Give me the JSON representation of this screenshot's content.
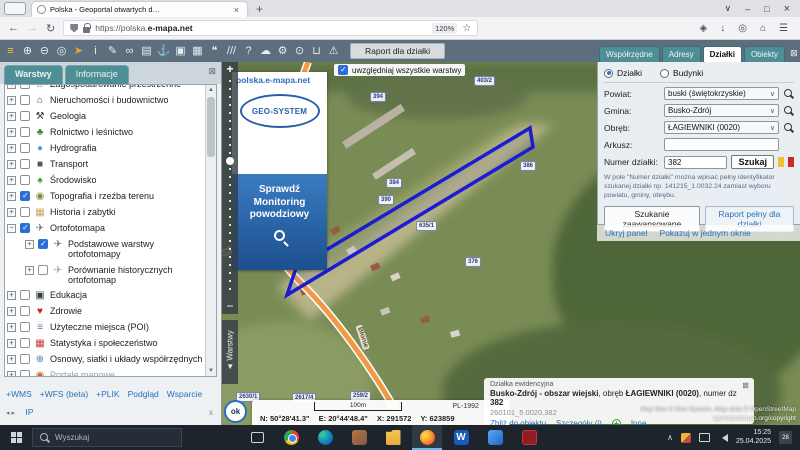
{
  "colors": {
    "accent_blue": "#2a6fbd",
    "teal": "#4e8e96",
    "parcel": "#1c1cd0",
    "road": "#f19a44",
    "toolbar_bg": "#5d6f7e"
  },
  "browser": {
    "tab_title": "Polska - Geoportal otwartych d…",
    "tab_close": "×",
    "new_tab": "+",
    "back": "←",
    "forward": "→",
    "reload": "↻",
    "url_prefix": "https://polska.",
    "url_domain": "e-mapa.net",
    "zoom_level": "120%",
    "star": "☆",
    "right_icons": [
      {
        "name": "pocket-icon",
        "g": "◈"
      },
      {
        "name": "downloads-icon",
        "g": "↓"
      },
      {
        "name": "account-icon",
        "g": "◎"
      },
      {
        "name": "home-icon",
        "g": "⌂"
      },
      {
        "name": "menu-icon",
        "g": "☰"
      }
    ],
    "win_list": "∨",
    "win_min": "–",
    "win_max": "□",
    "win_close": "×"
  },
  "toolbar": {
    "report_button": "Raport dla działki",
    "icons": [
      {
        "name": "layers-icon",
        "g": "≡",
        "c": "#f2c230"
      },
      {
        "name": "zoom-in-icon",
        "g": "⊕"
      },
      {
        "name": "zoom-out-icon",
        "g": "⊖"
      },
      {
        "name": "select-area-icon",
        "g": "◎"
      },
      {
        "name": "cursor-icon",
        "g": "➤",
        "c": "#f0a030"
      },
      {
        "name": "info-icon",
        "g": "i"
      },
      {
        "name": "measure-icon",
        "g": "✎"
      },
      {
        "name": "link-icon",
        "g": "∞"
      },
      {
        "name": "print-icon",
        "g": "▤"
      },
      {
        "name": "anchor-icon",
        "g": "⚓"
      },
      {
        "name": "copy-view-icon",
        "g": "▣"
      },
      {
        "name": "split-view-icon",
        "g": "▦"
      },
      {
        "name": "comment-icon",
        "g": "❝"
      },
      {
        "name": "measure-lines-icon",
        "g": "///"
      },
      {
        "name": "help-icon",
        "g": "?"
      },
      {
        "name": "upload-cloud-icon",
        "g": "☁"
      },
      {
        "name": "settings-icon",
        "g": "⚙"
      },
      {
        "name": "search-map-icon",
        "g": "⊙"
      },
      {
        "name": "cart-icon",
        "g": "⊔"
      },
      {
        "name": "warning-icon",
        "g": "⚠"
      }
    ]
  },
  "left_panel": {
    "tabs": [
      {
        "label": "Warstwy",
        "active": true
      },
      {
        "label": "Informacje",
        "active": false
      }
    ],
    "close_icon": "⊠",
    "scroll_up": "▲",
    "scroll_down": "▼",
    "layers": [
      {
        "label": "Zagospodarowanie przestrzenne",
        "expander": "+",
        "glyph": "⌂",
        "color": "#8a6d3b"
      },
      {
        "label": "Nieruchomości i budownictwo",
        "expander": "+",
        "glyph": "⌂",
        "color": "#44474a"
      },
      {
        "label": "Geologia",
        "expander": "+",
        "glyph": "⚒",
        "color": "#333"
      },
      {
        "label": "Rolnictwo i leśnictwo",
        "expander": "+",
        "glyph": "♣",
        "color": "#2e8b2e"
      },
      {
        "label": "Hydrografia",
        "expander": "+",
        "glyph": "●",
        "color": "#3fa9dd"
      },
      {
        "label": "Transport",
        "expander": "+",
        "glyph": "■",
        "color": "#555"
      },
      {
        "label": "Środowisko",
        "expander": "+",
        "glyph": "♠",
        "color": "#4a9b3a"
      },
      {
        "label": "Topografia i rzeźba terenu",
        "expander": "+",
        "checked": true,
        "glyph": "◉",
        "color": "#7a8b3a"
      },
      {
        "label": "Historia i zabytki",
        "expander": "+",
        "glyph": "▦",
        "color": "#c9a85c"
      },
      {
        "label": "Ortofotomapa",
        "expander": "−",
        "checked": true,
        "glyph": "✈",
        "color": "#6a7076"
      },
      {
        "label": "Podstawowe warstwy ortofotomapy",
        "expander": "+",
        "checked": true,
        "indent": true,
        "glyph": "✈",
        "color": "#6a7076"
      },
      {
        "label": "Porównanie historycznych ortofotomap",
        "expander": "+",
        "indent": true,
        "glyph": "✈",
        "color": "#9aa0a6"
      },
      {
        "label": "Edukacja",
        "expander": "+",
        "glyph": "▣",
        "color": "#2f3c44"
      },
      {
        "label": "Zdrowie",
        "expander": "+",
        "glyph": "♥",
        "color": "#cc2222"
      },
      {
        "label": "Użyteczne miejsca (POI)",
        "expander": "+",
        "glyph": "≡",
        "color": "#5577aa"
      },
      {
        "label": "Statystyka i społeczeństwo",
        "expander": "+",
        "glyph": "▦",
        "color": "#cc3333"
      },
      {
        "label": "Osnowy, siatki i układy współrzędnych",
        "expander": "+",
        "glyph": "⊕",
        "color": "#4a7ab5"
      },
      {
        "label": "Portale mapowe",
        "expander": "+",
        "muted": true,
        "glyph": "◉",
        "color": "#cc6633"
      },
      {
        "label": "Programy rządowe",
        "expander": "+",
        "glyph": "✉",
        "color": "#888"
      }
    ],
    "bottom_links": [
      {
        "label": "+WMS"
      },
      {
        "label": "+WFS (beta)"
      },
      {
        "label": "+PLIK"
      },
      {
        "label": "Podgląd"
      },
      {
        "label": "Wsparcie"
      }
    ],
    "pager_arrows": "◂ ▸",
    "ip_link": "IP",
    "foot_close": "x"
  },
  "map": {
    "all_layers_label": "uwzględniaj wszystkie warstwy",
    "watermark": "polska.e-mapa.net",
    "logo_text": "GEO-SYSTEM",
    "banner_line1": "Sprawdź",
    "banner_line2": "Monitoring",
    "banner_line3": "powodziowy",
    "zoom_plus": "+",
    "zoom_minus": "−",
    "warstwy_toggle": "◄ Warstwy",
    "streets": [
      {
        "label": "Pawła",
        "x": 6,
        "y": 180,
        "rot": -20
      },
      {
        "label": "Błonie",
        "x": 128,
        "y": 272,
        "rot": 72
      }
    ],
    "parcel_chips": [
      {
        "label": "403/2",
        "x": 252,
        "y": 14
      },
      {
        "label": "394",
        "x": 148,
        "y": 30
      },
      {
        "label": "384",
        "x": 164,
        "y": 116
      },
      {
        "label": "390",
        "x": 156,
        "y": 133
      },
      {
        "label": "386",
        "x": 298,
        "y": 99
      },
      {
        "label": "635/1",
        "x": 194,
        "y": 159
      },
      {
        "label": "376",
        "x": 243,
        "y": 195
      },
      {
        "label": "2630/1",
        "x": 14,
        "y": 330
      },
      {
        "label": "2617/4",
        "x": 70,
        "y": 331
      },
      {
        "label": "259/2",
        "x": 128,
        "y": 329
      }
    ],
    "ok_label": "ok",
    "scale_label": "100m",
    "crs_label": "PL-1992",
    "crs_caret": "∨",
    "coord_n": "N: 50°28'41.3\"",
    "coord_e": "E: 20°44'48.4\"",
    "coord_x": "X: 291572",
    "coord_y": "Y: 623859",
    "attribution_line1": "Map tiles © Geo-System, Map data © OpenStreetMap",
    "attribution_line2": "openstreetmap.org/copyright"
  },
  "info_card": {
    "title": "Działka ewidencyjna",
    "close": "⊠",
    "name_bold1": "Busko-Zdrój - obszar wiejski",
    "name_mid": ", obręb ",
    "name_bold2": "ŁAGIEWNIKI (0020)",
    "name_mid2": ", numer dz ",
    "name_bold3": "382",
    "parcel_id": "260101_5.0020.382",
    "link_zoom": "Zbliż do obiektu",
    "link_details": "Szczegóły (i)",
    "plus": "+",
    "link_other": "Inne"
  },
  "right_panel": {
    "tabs": [
      {
        "label": "Współrzędne",
        "active": false
      },
      {
        "label": "Adresy",
        "active": false
      },
      {
        "label": "Działki",
        "active": true
      },
      {
        "label": "Obiekty",
        "active": false
      }
    ],
    "close_icon": "⊠",
    "radio_parcels": "Działki",
    "radio_buildings": "Budynki",
    "fields": [
      {
        "label": "Powiat:",
        "value": "buski (świętokrzyskie)"
      },
      {
        "label": "Gmina:",
        "value": "Busko-Zdrój"
      },
      {
        "label": "Obręb:",
        "value": "ŁAGIEWNIKI (0020)"
      }
    ],
    "caret": "∨",
    "arkusz_label": "Arkusz:",
    "arkusz_value": "",
    "number_label": "Numer działki:",
    "number_value": "382",
    "search_button": "Szukaj",
    "hint": "W pole \"Numer działki\" można wpisać pełny identyfikator szukanej działki np. 141215_1.0032.24 zamiast wyboru powiatu, gminy, obrębu.",
    "btn_advanced": "Szukanie zaawansowane",
    "btn_report": "Raport pełny dla działki",
    "link_hide": "Ukryj panel",
    "link_one_window": "Pokazuj w jednym oknie"
  },
  "taskbar": {
    "search_placeholder": "Wyszukaj",
    "apps": [
      {
        "name": "task-view-icon",
        "cls": "taskview"
      },
      {
        "name": "chrome-icon",
        "cls": "chrome"
      },
      {
        "name": "edge-icon",
        "cls": "edge"
      },
      {
        "name": "hand-app-icon",
        "cls": "handapp"
      },
      {
        "name": "file-explorer-icon",
        "cls": "explorer"
      },
      {
        "name": "firefox-icon",
        "cls": "firefox",
        "active": true
      },
      {
        "name": "word-icon",
        "cls": "word",
        "letter": "W"
      },
      {
        "name": "photos-icon",
        "cls": "photos"
      },
      {
        "name": "acrobat-icon",
        "cls": "acrobat"
      }
    ],
    "tray_chevron": "∧",
    "time": "15:25",
    "date": "25.04.2025",
    "badge": "28"
  }
}
